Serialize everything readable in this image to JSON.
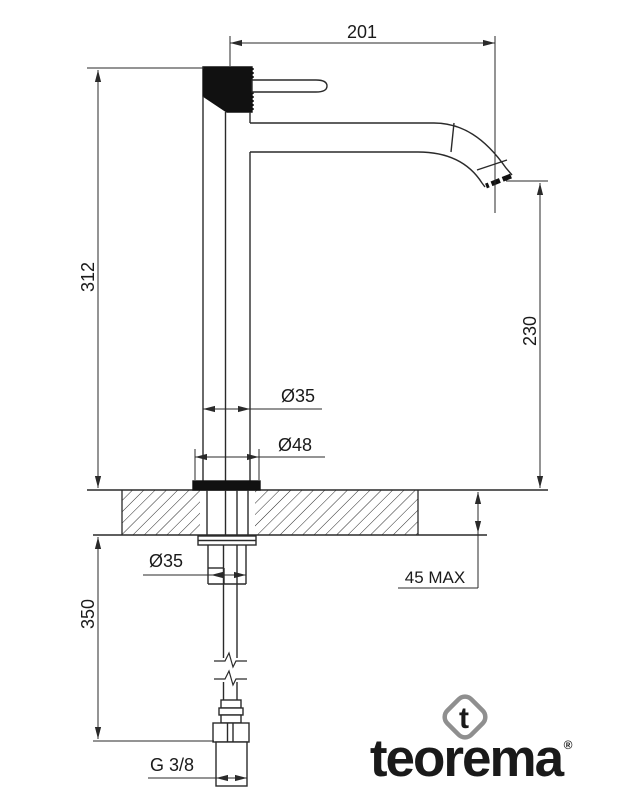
{
  "dimensions": {
    "spout_reach": "201",
    "total_height": "312",
    "spout_height": "230",
    "body_diameter": "Ø35",
    "base_diameter": "Ø48",
    "shank_diameter": "Ø35",
    "max_counter_thickness": "45 MAX",
    "under_counter_length": "350",
    "inlet_thread": "G 3/8"
  },
  "logo": {
    "wordmark": "teorema",
    "mark_letter": "t",
    "registered_symbol": "®",
    "colors": {
      "blue": "#1377b5",
      "green": "#76b82a",
      "gray": "#8f8f8f"
    }
  },
  "drawing": {
    "line_color": "#2a2a2a",
    "background": "#ffffff"
  }
}
